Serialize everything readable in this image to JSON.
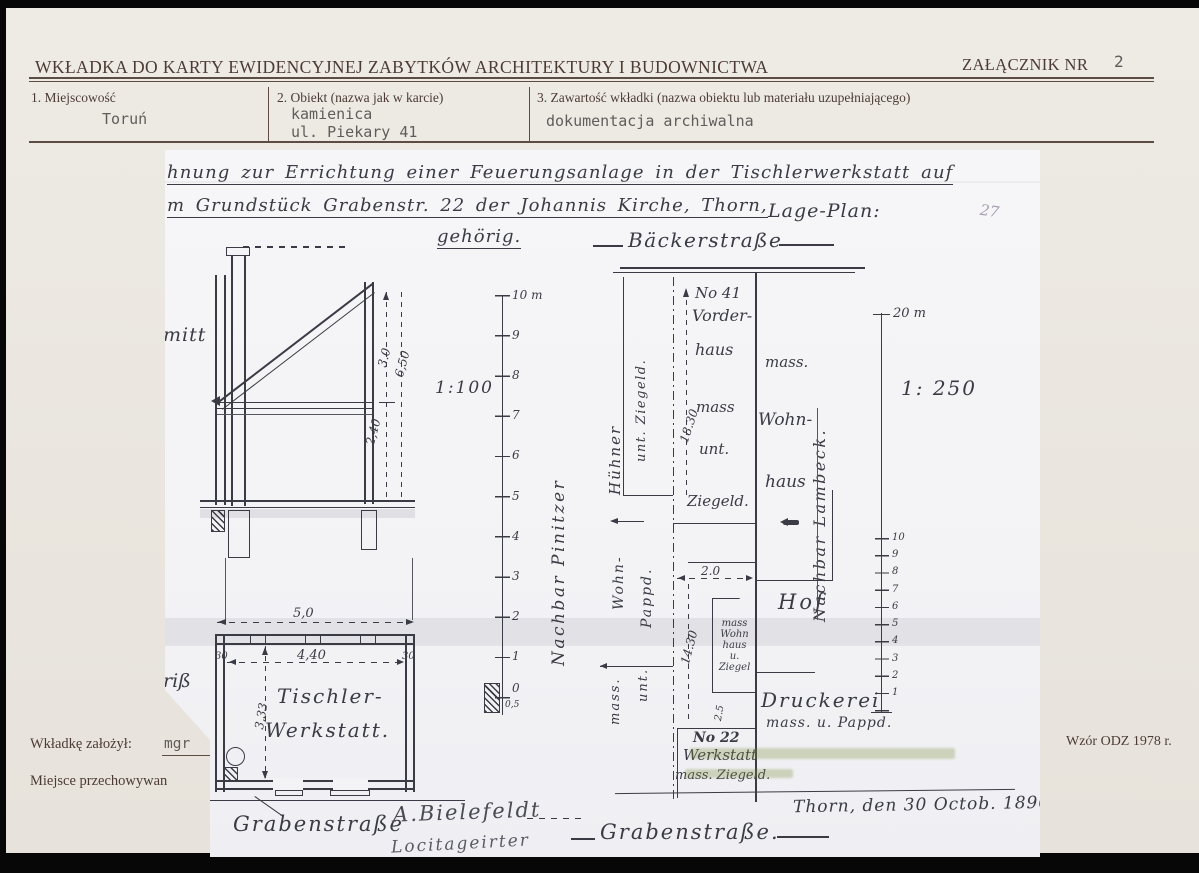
{
  "form": {
    "title": "WKŁADKA DO KARTY EWIDENCYJNEJ ZABYTKÓW ARCHITEKTURY I BUDOWNICTWA",
    "attachment_label": "ZAŁĄCZNIK NR",
    "attachment_number": "2",
    "field1_label": "1. Miejscowość",
    "field1_value": "Toruń",
    "field2_label": "2. Obiekt (nazwa jak w karcie)",
    "field2_value_line1": "kamienica",
    "field2_value_line2": "ul. Piekary 41",
    "field3_label": "3. Zawartość wkładki (nazwa obiektu lub materiału uzupełniającego)",
    "field3_value": "dokumentacja archiwalna",
    "footer_author_label": "Wkładkę założył:",
    "footer_author_value": "mgr",
    "footer_storage_label": "Miejsce przechowywan",
    "footer_template_note": "Wzór ODZ 1978 r."
  },
  "drawing": {
    "title_line1": "hnung zur Errichtung einer Feuerungsanlage in der Tischlerwerkstatt auf",
    "title_line2": "m Grundstück Grabenstr. 22 der Johannis Kirche, Thorn,",
    "title_line2_right": "Lage-Plan:",
    "title_line3": "gehörig.",
    "pencil_note": "27",
    "section": {
      "partial_word": "mitt",
      "scale_label": "1:100",
      "dim_roof": "3.0",
      "dim_total": "6,50",
      "dim_floor": "2,40"
    },
    "scale100": {
      "top": "10 m",
      "ticks": [
        "9",
        "8",
        "7",
        "6",
        "5",
        "4",
        "3",
        "2",
        "1",
        "0"
      ],
      "half": "0,5",
      "neighbor": "Nachbar Pinitzer"
    },
    "plan": {
      "partial_word": "riß",
      "dim_total": "5,0",
      "dim_inner": "4,40",
      "wall_left": "30",
      "wall_right": "30",
      "dim_depth": "3,33",
      "room_line1": "Tischler-",
      "room_line2": "Werkstatt.",
      "street": "Grabenstraße"
    },
    "site": {
      "street_top": "Bäckerstraße",
      "no41": "No 41",
      "vorderhaus_line1": "Vorder-",
      "vorderhaus_line2": "haus",
      "vorderhaus_line3": "mass",
      "vorderhaus_line4": "unt.",
      "dim_front": "18.30",
      "left_wing_word1": "Hühner",
      "left_wing_word2": "unt. Ziegeld.",
      "right_house_line1": "mass.",
      "right_house_line2": "Wohn-",
      "right_house_line3": "haus",
      "neighbor_right": "Nachbar Lambeck.",
      "ziegeld": "Ziegeld.",
      "dim_width": "2.0",
      "dim_yard": "14.30",
      "dim_small": "2.5",
      "octagon": [
        "mass",
        "Wohn",
        "haus",
        "u.",
        "Ziegel"
      ],
      "hof": "Hof",
      "druckerei_line1": "Druckerei",
      "druckerei_line2": "mass. u. Pappd.",
      "left_mid_word1": "Wohn-",
      "left_mid_word2": "Pappd.",
      "left_mid_word3": "mass.",
      "left_mid_word4": "unt.",
      "no22": "No 22",
      "no22_line2": "Werkstatt",
      "no22_line3": "mass. Ziegeld.",
      "street_bottom": "Grabenstraße.",
      "date": "Thorn, den 30 Octob. 1896."
    },
    "scale250": {
      "top": "20 m",
      "label": "1: 250",
      "ticks": [
        "10",
        "9",
        "8",
        "7",
        "6",
        "5",
        "4",
        "3",
        "2",
        "1"
      ]
    },
    "signature_line1": "A.Bielefeldt",
    "signature_line2": "Locitageirter"
  }
}
